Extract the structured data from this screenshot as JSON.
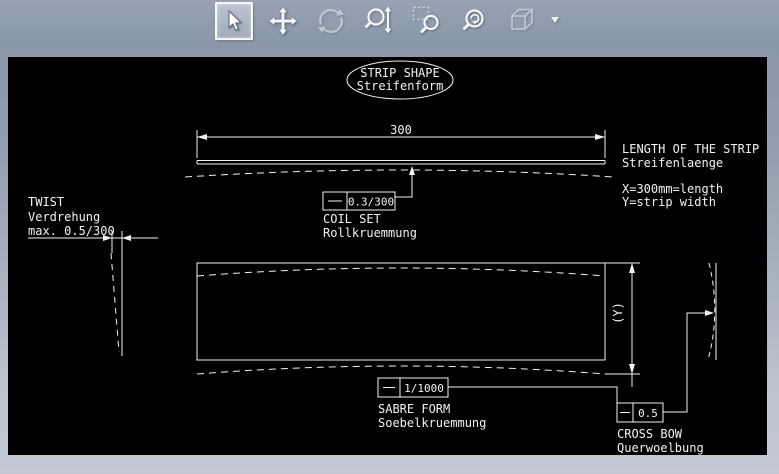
{
  "window": {
    "chrome_top_color": "#8b98aa",
    "chrome_bottom_color": "#c4c9d3",
    "canvas_bg": "#000000",
    "line_color": "#f2f2f2",
    "selected_button_border": "#f6f8fa"
  },
  "toolbar": {
    "buttons": [
      {
        "icon": "cursor-arrow-icon",
        "selected": true,
        "disabled": false
      },
      {
        "icon": "pan-icon",
        "selected": false,
        "disabled": false
      },
      {
        "icon": "orbit-icon",
        "selected": false,
        "disabled": true
      },
      {
        "icon": "zoom-vertical-icon",
        "selected": false,
        "disabled": false
      },
      {
        "icon": "zoom-window-icon",
        "selected": false,
        "disabled": false
      },
      {
        "icon": "zoom-circle-icon",
        "selected": false,
        "disabled": false
      },
      {
        "icon": "cube-icon",
        "selected": false,
        "disabled": true
      },
      {
        "icon": "dropdown-arrow-icon",
        "selected": false,
        "disabled": false
      }
    ]
  },
  "drawing": {
    "title": {
      "line1": "STRIP SHAPE",
      "line2": "Streifenform"
    },
    "length_dimension": "300",
    "coil_set": {
      "tolerance": "0.3/300",
      "label_en": "COIL SET",
      "label_de": "Rollkruemmung"
    },
    "length_note": {
      "line1": "LENGTH OF THE STRIP",
      "line2": "Streifenlaenge",
      "line3": "X=300mm=length",
      "line4": "Y=strip width"
    },
    "twist": {
      "label_en": "TWIST",
      "label_de": "Verdrehung",
      "max_label": "max. 0.5/300"
    },
    "width_dimension": "(Y)",
    "sabre_form": {
      "tolerance": "1/1000",
      "label_en": "SABRE FORM",
      "label_de": "Soebelkruemmung"
    },
    "cross_bow": {
      "tolerance": "0.5",
      "label_en": "CROSS BOW",
      "label_de": "Querwoelbung"
    }
  }
}
